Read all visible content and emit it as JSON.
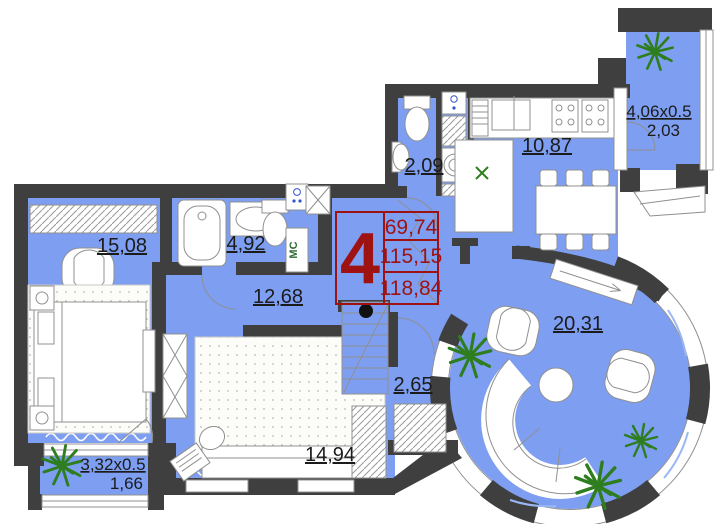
{
  "plan": {
    "stamp": {
      "number": "4",
      "values": [
        "69,74",
        "115,15",
        "118,84"
      ]
    },
    "rooms": {
      "bedroom": "15,08",
      "bathroom": "4,92",
      "hallway": "12,68",
      "wc": "2,09",
      "kitchen": "10,87",
      "corridor": "2,65",
      "bedroom2": "14,94",
      "living_room": "20,31"
    },
    "balcony_top_right": {
      "dimensions": "4,06x0.5",
      "area": "2,03"
    },
    "balcony_bottom_left": {
      "dimensions": "3,32x0.5",
      "area": "1,66"
    },
    "labels": {
      "garbage_chute": "МС"
    },
    "colors": {
      "floor": "#7d9ef1",
      "walls": "#3f3f3f",
      "stamp_red": "#9e1212",
      "plant_green": "#2e7d1f",
      "label_text": "#1b1b1b"
    }
  }
}
